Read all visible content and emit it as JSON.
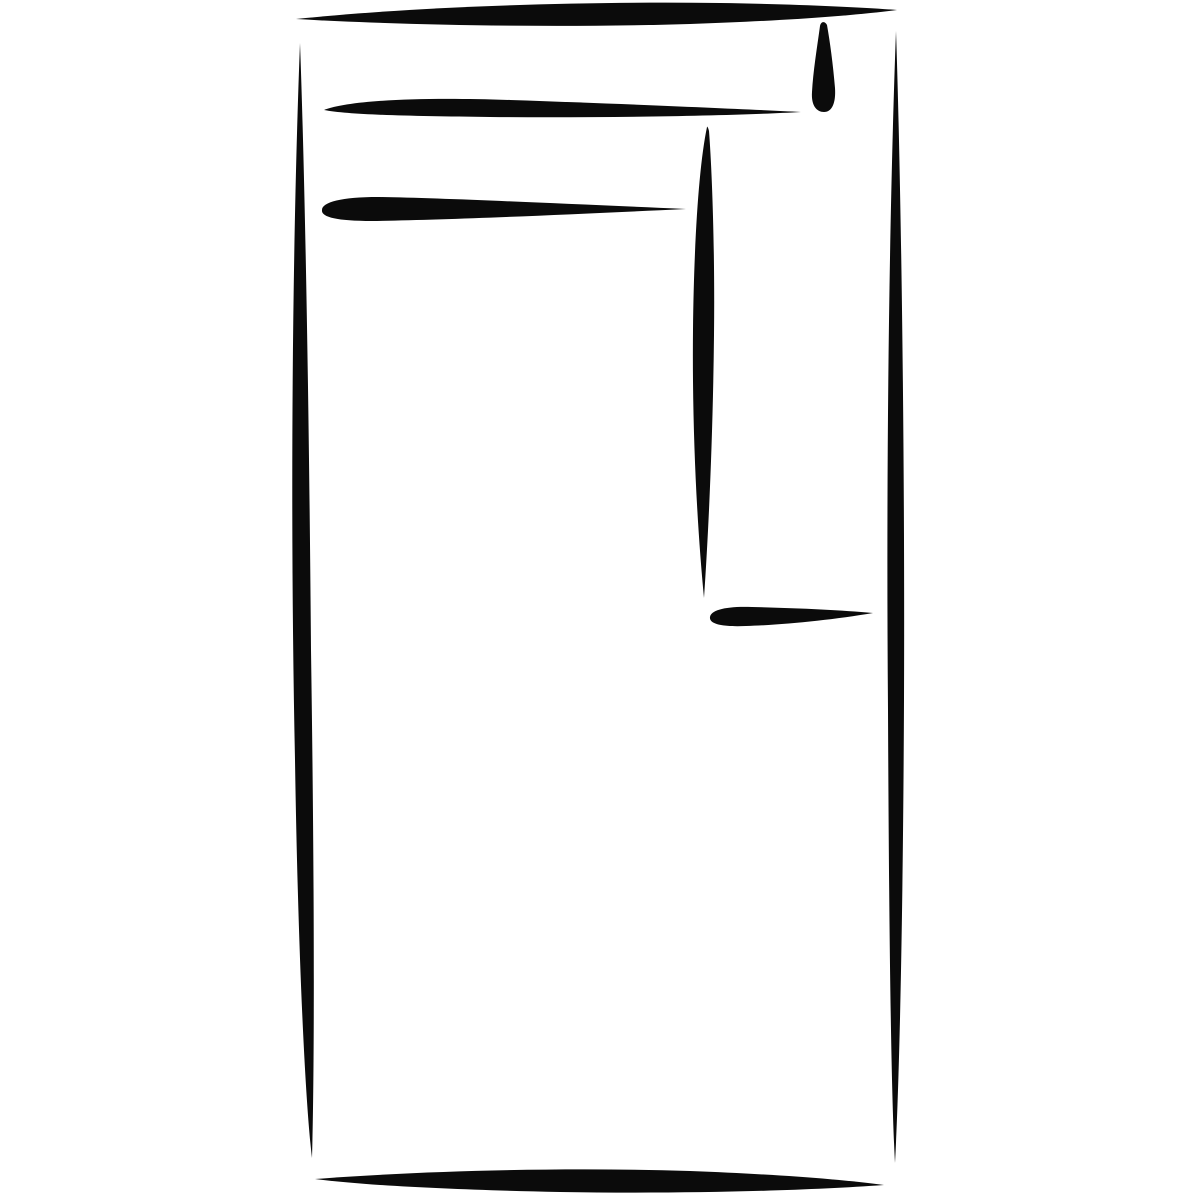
{
  "canvas": {
    "width": 1200,
    "height": 1200,
    "background_color": "#ffffff",
    "ink_color": "#0b0b0b"
  },
  "drawing": {
    "strokes": [
      {
        "name": "top-edge-stroke",
        "kind": "horizontal-brush-line",
        "d": "M296,19 C400,8 560,1 720,3 C790,4 860,7 897,10 C850,16 780,21 690,24 C550,28 400,25 296,19 Z"
      },
      {
        "name": "left-edge-stroke",
        "kind": "vertical-brush-line",
        "d": "M300,43 C292,250 290,520 295,760 C298,950 305,1100 312,1158 C315,1050 314,850 311,650 C309,400 305,180 300,43 Z"
      },
      {
        "name": "right-edge-stroke",
        "kind": "vertical-brush-line",
        "d": "M896,31 C889,220 886,470 888,710 C889,930 891,1090 895,1163 C899,1090 903,930 904,700 C905,450 901,180 896,31 Z"
      },
      {
        "name": "bottom-edge-stroke",
        "kind": "horizontal-brush-line",
        "d": "M315,1179 C420,1171 560,1167 690,1171 C770,1174 840,1179 884,1185 C800,1191 680,1194 560,1192 C460,1190 370,1186 315,1179 Z"
      },
      {
        "name": "header-rule-stroke",
        "kind": "horizontal-brush-line",
        "d": "M324,110 C350,100 420,97 510,100 C630,104 740,109 801,112 C730,116 600,118 490,117 C410,116 350,115 324,110 Z"
      },
      {
        "name": "ink-drip-stroke",
        "kind": "teardrop-drip",
        "d": "M820,26 C817,48 813,72 812,92 C811,106 817,112 824,112 C832,112 836,103 835,88 C833,64 830,42 827,25 C825,21 821,21 820,26 Z"
      },
      {
        "name": "subheader-rule-stroke",
        "kind": "horizontal-brush-line",
        "d": "M322,210 C322,202 342,197 378,197 C440,198 550,203 686,209 C560,215 445,220 372,221 C336,221 321,217 322,210 Z"
      },
      {
        "name": "inner-vertical-divider-stroke",
        "kind": "vertical-brush-line",
        "d": "M707,127 C699,165 694,240 693,330 C692,430 697,525 704,598 C709,525 713,430 714,335 C715,250 712,170 709,131 C708,127 707,126 707,127 Z"
      },
      {
        "name": "inner-underline-stroke",
        "kind": "horizontal-brush-line",
        "d": "M710,617 C711,610 726,606 752,607 C795,608 840,610 873,613 C832,620 782,625 746,626 C722,627 709,624 710,617 Z"
      }
    ]
  }
}
